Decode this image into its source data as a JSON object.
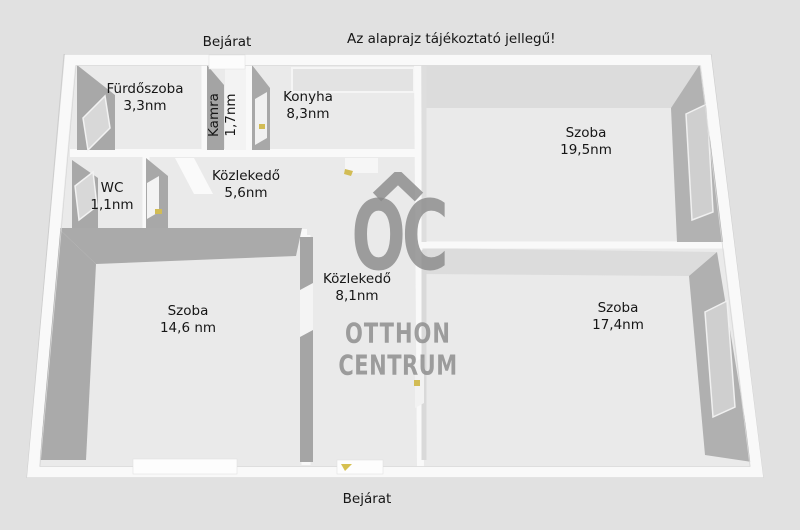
{
  "note": "Az alaprajz tájékoztató jellegű!",
  "entrance_top_label": "Bejárat",
  "entrance_bottom_label": "Bejárat",
  "watermark": {
    "monogram": "OC",
    "line1": "OTTHON",
    "line2": "CENTRUM"
  },
  "rooms": [
    {
      "name": "Fürdőszoba",
      "area": "3,3nm"
    },
    {
      "name": "Kamra",
      "area": "1,7nm"
    },
    {
      "name": "Konyha",
      "area": "8,3nm"
    },
    {
      "name": "Szoba",
      "area": "19,5nm"
    },
    {
      "name": "WC",
      "area": "1,1nm"
    },
    {
      "name": "Közlekedő",
      "area": "5,6nm"
    },
    {
      "name": "Közlekedő",
      "area": "8,1nm"
    },
    {
      "name": "Szoba",
      "area": "14,6 nm"
    },
    {
      "name": "Szoba",
      "area": "17,4nm"
    }
  ],
  "colors": {
    "background": "#e1e1e1",
    "floor": "#eaeaea",
    "wall_white": "#f9f9f9",
    "wall_face_dark": "#a8a8a8",
    "ceiling_band": "#dcdcdc",
    "watermark_gray": "#888888",
    "door_marker_yellow": "#d2bc55",
    "text": "#161616"
  }
}
